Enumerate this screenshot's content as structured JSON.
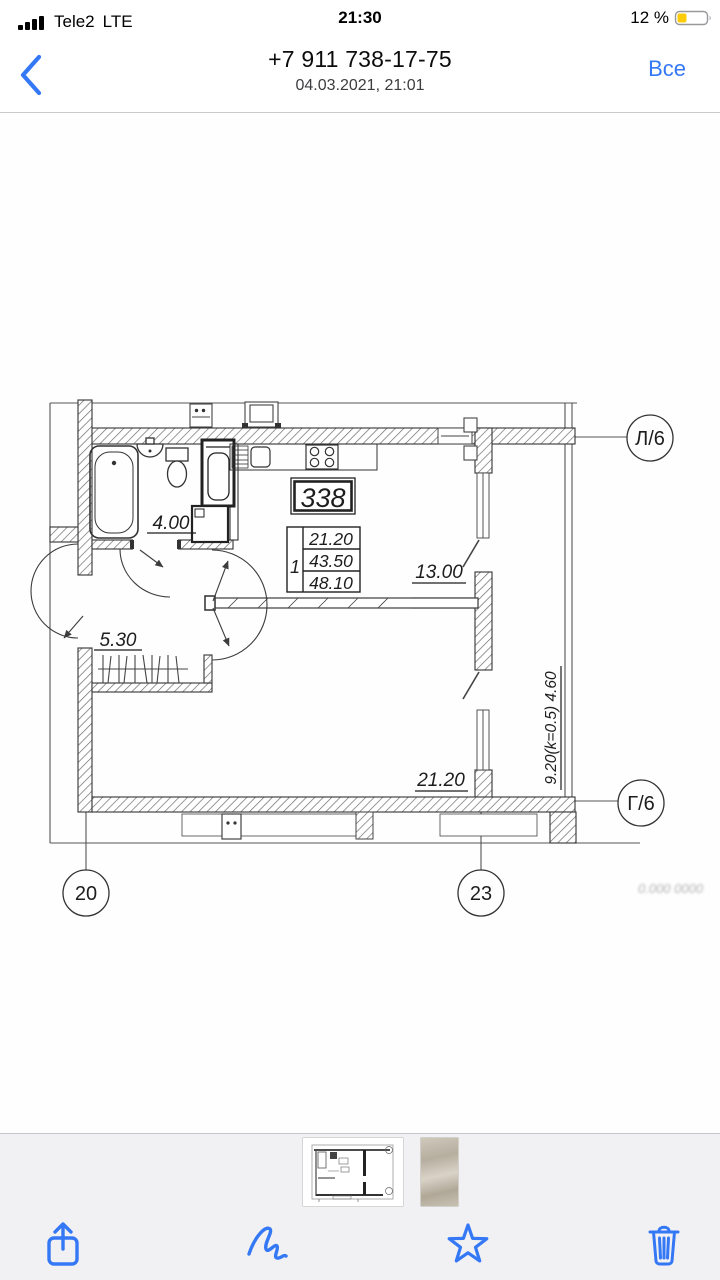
{
  "status_bar": {
    "carrier": "Tele2",
    "network": "LTE",
    "time": "21:30",
    "battery_percent": "12 %",
    "battery_color": "#FFCC0A"
  },
  "nav": {
    "title": "+7 911 738-17-75",
    "subtitle": "04.03.2021, 21:01",
    "all_label": "Все",
    "accent_color": "#3478F6"
  },
  "plan": {
    "apartment_number": "338",
    "info_table": {
      "rooms": "1",
      "living_area": "21.20",
      "apartment_area": "43.50",
      "total_area": "48.10"
    },
    "room_labels": {
      "bathroom": "4.00",
      "hall": "5.30",
      "kitchen": "13.00",
      "living": "21.20",
      "loggia": "9.20(k=0.5) 4.60"
    },
    "axis_labels": {
      "top_right": "Л/6",
      "bottom_right": "Г/6",
      "bottom_left": "20",
      "bottom_center": "23"
    },
    "faint_marks": "0.000    0000"
  },
  "toolbar": {
    "icons": [
      "share",
      "markup",
      "star",
      "trash"
    ]
  }
}
